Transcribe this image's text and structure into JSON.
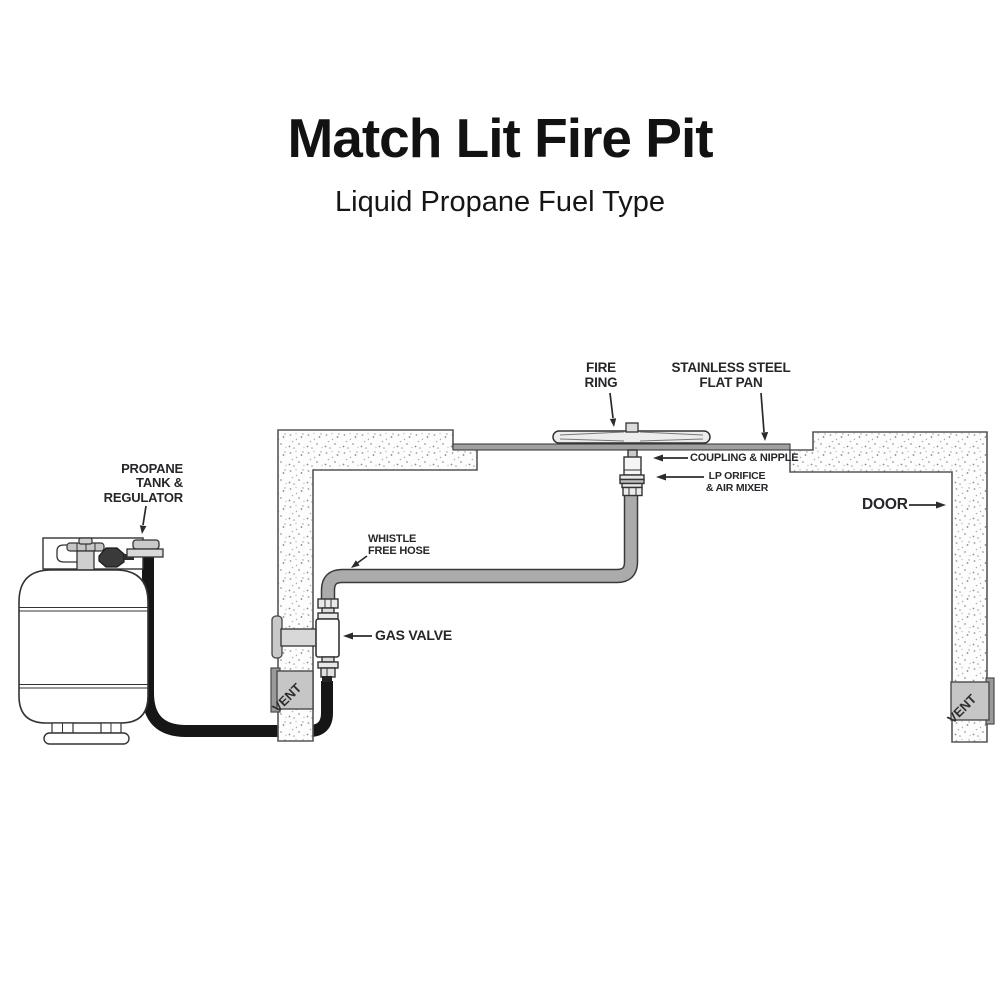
{
  "header": {
    "title": "Match Lit Fire Pit",
    "subtitle": "Liquid Propane Fuel Type"
  },
  "labels": {
    "propane_tank": [
      "PROPANE",
      "TANK &",
      "REGULATOR"
    ],
    "whistle_free_hose": [
      "WHISTLE",
      "FREE HOSE"
    ],
    "gas_valve": "GAS VALVE",
    "fire_ring": [
      "FIRE",
      "RING"
    ],
    "flat_pan": [
      "STAINLESS STEEL",
      "FLAT PAN"
    ],
    "coupling_nipple": "COUPLING & NIPPLE",
    "lp_orifice": [
      "LP ORIFICE",
      "& AIR MIXER"
    ],
    "door": "DOOR",
    "vent_left": "VENT",
    "vent_right": "VENT"
  },
  "colors": {
    "label_ink": "#26262b",
    "title_ink": "#121212",
    "whistle_hose_gray": "#ababab",
    "supply_hose_black": "#161616",
    "wall_outline": "#57575b",
    "vent_block_gray": "#c6c6c6",
    "pan_gray": "#a0a0a0",
    "background": "#ffffff"
  }
}
